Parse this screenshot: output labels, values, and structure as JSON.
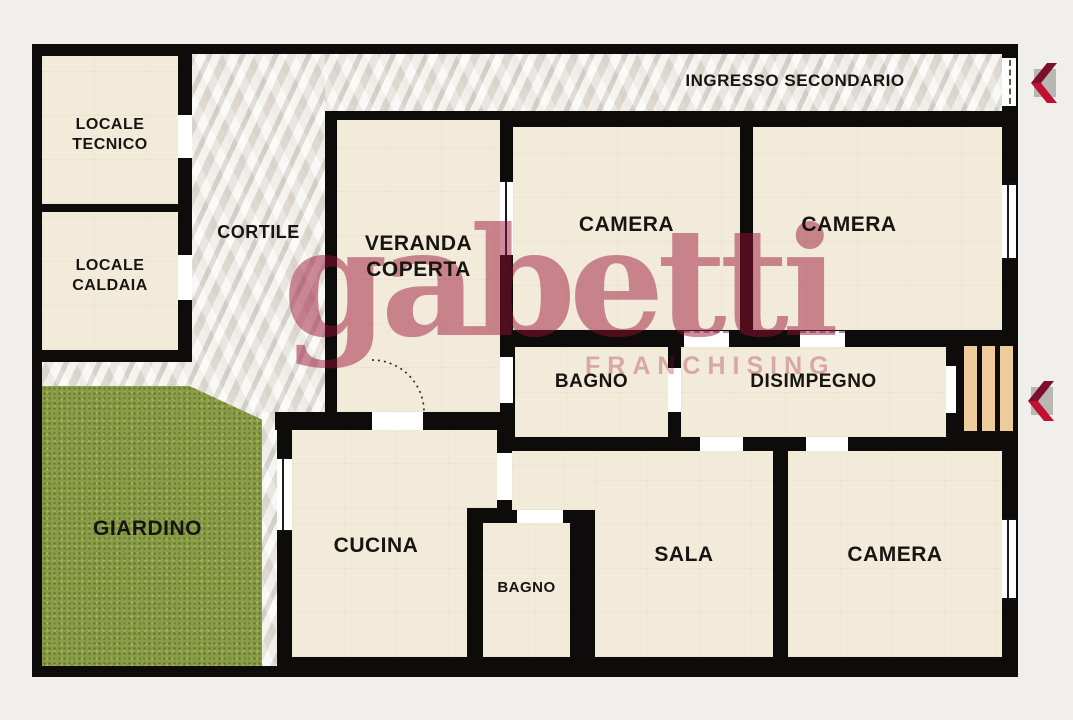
{
  "floorplan": {
    "watermark": {
      "brand": "gabetti",
      "sub": "FRANCHISING"
    },
    "labels": {
      "locale_tecnico": "LOCALE\nTECNICO",
      "locale_caldaia": "LOCALE\nCALDAIA",
      "cortile": "CORTILE",
      "ingresso_secondario": "INGRESSO SECONDARIO",
      "veranda_coperta": "VERANDA\nCOPERTA",
      "camera_nord_ovest": "CAMERA",
      "camera_nord_est": "CAMERA",
      "bagno_centrale": "BAGNO",
      "disimpegno": "DISIMPEGNO",
      "giardino": "GIARDINO",
      "cucina": "CUCINA",
      "bagno_sud": "BAGNO",
      "sala": "SALA",
      "camera_sud": "CAMERA"
    },
    "colors": {
      "background": "#f0efec",
      "walls": "#0d0c0a",
      "room_floor": "#f2ebd9",
      "marble_floor": "#e9e7e2",
      "garden": "#8b9c47",
      "stairs": "#edcb9b",
      "watermark_red": "#981434",
      "arrow_red_bright": "#c11031",
      "arrow_red_dark": "#7d0f2c",
      "arrow_backing_gray": "#b9b7b3"
    }
  }
}
